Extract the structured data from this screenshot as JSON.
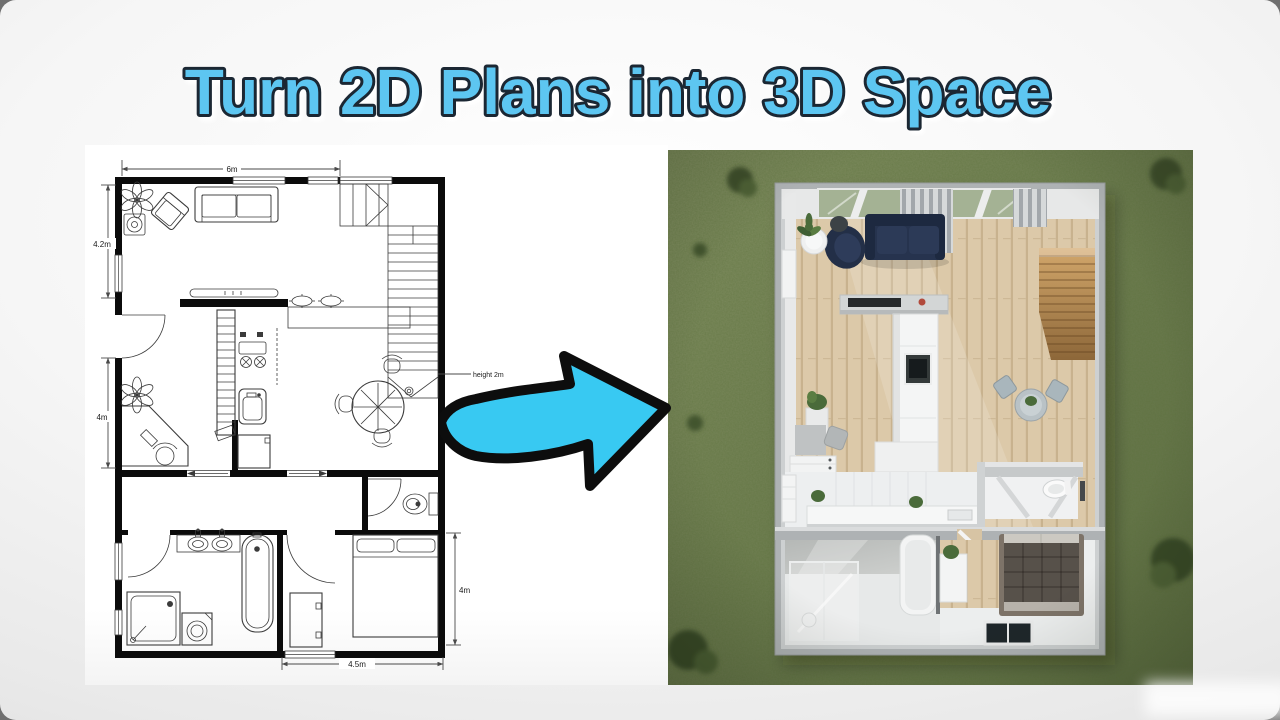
{
  "title": {
    "text": "Turn 2D Plans into 3D Space",
    "color": "#5dc6f1",
    "outline_color": "#1b2733"
  },
  "floorplan_2d": {
    "dimensions": {
      "top_width": "6m",
      "left_upper": "4.2m",
      "left_lower": "4m",
      "right_lower": "4m",
      "bottom_width": "4.5m"
    },
    "annotation": {
      "height_note": "height 2m"
    }
  },
  "transform_arrow": {
    "fill_color": "#38c9f2",
    "outline_color": "#0d0d0d"
  },
  "render_3d": {
    "colors": {
      "grass": "#6e7d51",
      "wood_floor": "#dcc9a9",
      "stairs": "#c49a62",
      "sofa": "#26334e",
      "walls": "#aeb2b4",
      "bed": "#57514a"
    }
  }
}
